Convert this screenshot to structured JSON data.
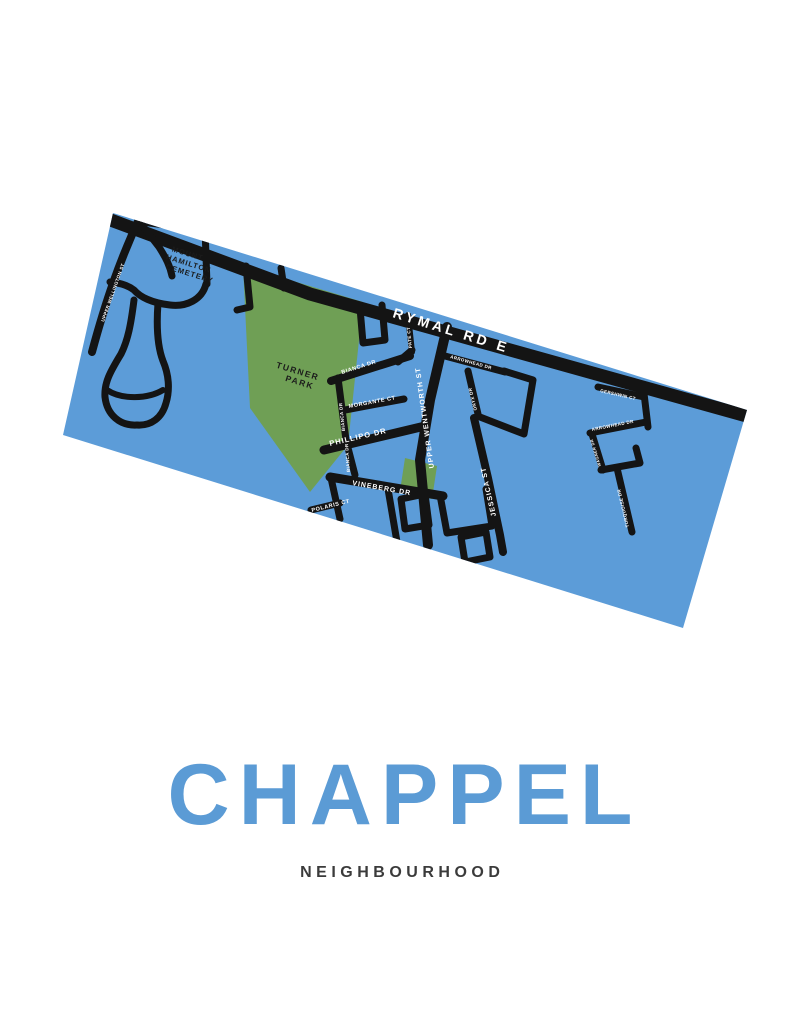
{
  "poster": {
    "title": "CHAPPEL",
    "subtitle": "NEIGHBOURHOOD",
    "title_color": "#5b9bd5",
    "subtitle_color": "#3b3b3b"
  },
  "map": {
    "base_color": "#5c9cd8",
    "park_color": "#6f9f55",
    "road_color": "#141414",
    "street_label_color": "#ffffff",
    "areas": {
      "cemetery": {
        "line1": "MOUNT",
        "line2": "HAMILTON",
        "line3": "CEMETERY"
      },
      "park": {
        "line1": "TURNER",
        "line2": "PARK"
      }
    },
    "streets": {
      "rymal": "RYMAL RD E",
      "upper_wellington": "UPPER WELLINGTON ST",
      "bianca": "BIANCA DR",
      "pate": "PATE CT",
      "morgante": "MORGANTE CT",
      "phillipo": "PHILLIPO DR",
      "vineberg": "VINEBERG DR",
      "polaris": "POLARIS CT",
      "upper_wentworth": "UPPER WENTWORTH ST",
      "arrowhead": "ARROWHEAD DR",
      "onyx": "ONYX DR",
      "jessica": "JESSICA ST",
      "gershwin": "GERSHWIN CT",
      "wagner": "WAGNER DR",
      "turquoise": "TURQUOISE DR"
    }
  }
}
